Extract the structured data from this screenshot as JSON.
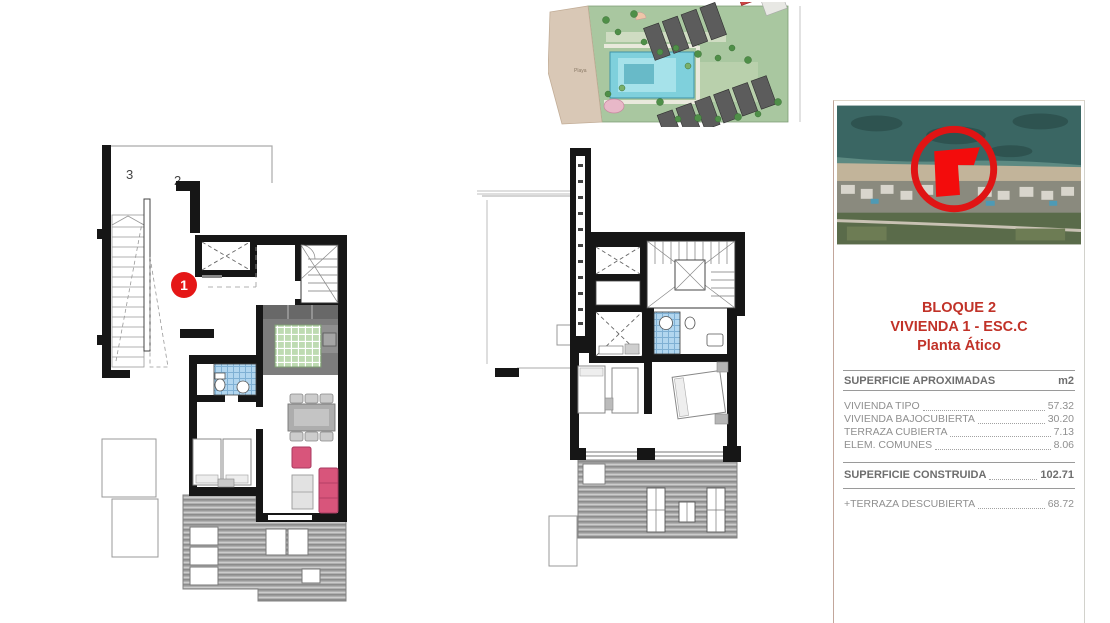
{
  "site_plan": {
    "beach_label": "Playa"
  },
  "floor_plan_left": {
    "unit_label_top": "3",
    "unit_label_right": "2",
    "marker_label": "1",
    "marker_color": "#e51717"
  },
  "panel": {
    "title_line1": "BLOQUE 2",
    "title_line2": "VIVIENDA 1 - ESC.C",
    "title_line3": "Planta Ático",
    "accent_color": "#c13228",
    "table": {
      "header_label": "SUPERFICIE APROXIMADAS",
      "header_unit": "m2",
      "rows": [
        {
          "label": "VIVIENDA TIPO",
          "value": "57.32"
        },
        {
          "label": "VIVIENDA BAJOCUBIERTA",
          "value": "30.20"
        },
        {
          "label": "TERRAZA CUBIERTA",
          "value": "7.13"
        },
        {
          "label": "ELEM. COMUNES",
          "value": "8.06"
        }
      ],
      "total_label": "SUPERFICIE CONSTRUIDA",
      "total_value": "102.71",
      "extra_label": "+TERRAZA DESCUBIERTA",
      "extra_value": "68.72"
    }
  },
  "colors": {
    "wall_black": "#161616",
    "terrace_gray": "#b0b0b0",
    "kitchen_green": "#bedbb2",
    "bath_blue": "#b2d6ef",
    "sofa_pink": "#d8557b",
    "pool_cyan": "#7fd0dc",
    "beach_tan": "#d9c8b6",
    "sea_teal": "#3a6663",
    "marker_red": "#e51717"
  }
}
